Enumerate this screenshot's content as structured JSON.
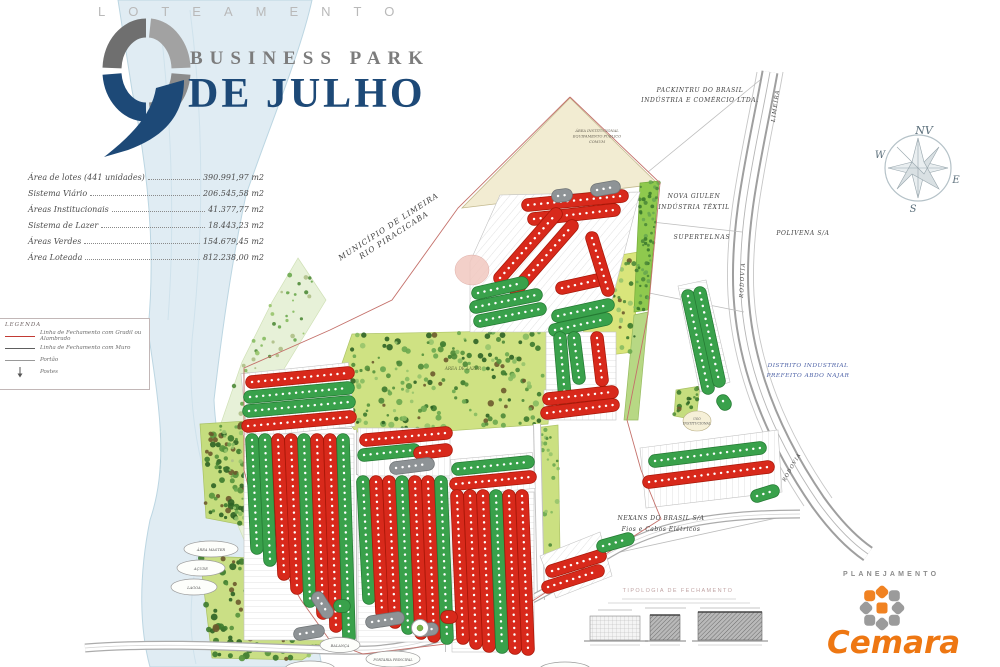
{
  "header": {
    "loteamento": "LOTEAMENTO",
    "business_park": "BUSINESS PARK",
    "de_julho": "DE JULHO"
  },
  "stats": {
    "items": [
      {
        "label": "Área de lotes (441 unidades)",
        "value": "390.991,97 m2"
      },
      {
        "label": "Sistema Viário",
        "value": "206.545,58 m2"
      },
      {
        "label": "Áreas Institucionais",
        "value": "41.377,77 m2"
      },
      {
        "label": "Sistema de Lazer",
        "value": "18.443,23 m2"
      },
      {
        "label": "Áreas Verdes",
        "value": "154.679,45 m2"
      },
      {
        "label": "Área Loteada",
        "value": "812.238,00 m2"
      }
    ]
  },
  "legend": {
    "title": "LEGENDA",
    "items": [
      {
        "label": "Linha de Fechamento com Gradil ou Alambrado"
      },
      {
        "label": "Linha de Fechamento com Muro"
      },
      {
        "label": "Portão"
      },
      {
        "label": "Postes"
      }
    ]
  },
  "compass": {
    "n": "NV",
    "w": "W",
    "e": "E",
    "s": "S"
  },
  "map_labels": {
    "municipio_1": "MUNICÍPIO DE LIMEIRA",
    "municipio_2": "RIO PIRACICABA",
    "packintru_1": "PACKINTRU DO BRASIL",
    "packintru_2": "INDÚSTRIA E COMÉRCIO LTDA.",
    "limeira": "LIMEIRA",
    "nova_1": "NOVA GIULEN",
    "nova_2": "INDÚSTRIA TÊXTIL",
    "supertelnas": "SUPERTELNAS",
    "polivena": "POLIVENA S/A",
    "rodovia": "RODOVIA",
    "distrito_1": "DISTRITO INDUSTRIAL",
    "distrito_2": "PREFEITO ABDO NAJAR",
    "nexans_1": "NEXANS DO BRASIL S/A",
    "nexans_2": "Fios e Cabos Elétricos",
    "area_lazer": "ÁREA DE LAZER",
    "inst_1": "ÁREA INSTITUCIONAL",
    "inst_2": "EQUIPAMENTO PÚBLICO",
    "inst_3": "COMUM",
    "uso_1": "USO",
    "uso_2": "INSTITUCIONAL",
    "oval_area_master": "ÁREA MASTER",
    "oval_acude": "AÇUDE",
    "oval_lagoa": "LAGOA",
    "oval_balanca": "BALANÇA",
    "oval_portaria": "PORTARIA PRINCIPAL"
  },
  "typology": {
    "title": "TIPOLOGIA DE FECHAMENTO"
  },
  "branding": {
    "planejamento": "PLANEJAMENTO",
    "company": "Cemara"
  },
  "colors": {
    "lot_sold_red": "#d8291b",
    "lot_available_green": "#39a14b",
    "lot_reserved_gray": "#8e9396",
    "logo_blue": "#1d4977",
    "cemara_orange": "#ee7712",
    "river_blue": "#e0ecf3",
    "park_green": "#cfe283"
  }
}
